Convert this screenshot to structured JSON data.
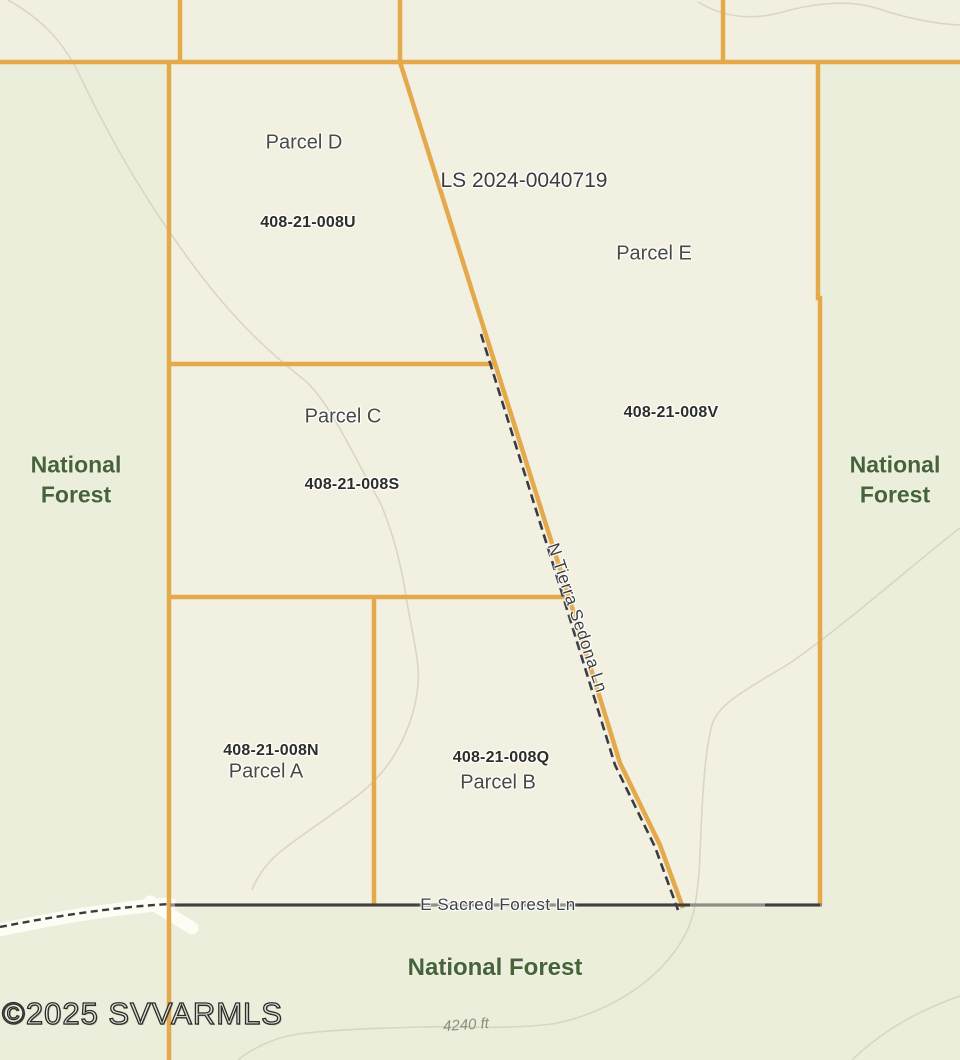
{
  "parcels": [
    {
      "name": "Parcel D",
      "apn": "408-21-008U"
    },
    {
      "name": "Parcel E",
      "apn": "408-21-008V"
    },
    {
      "name": "Parcel C",
      "apn": "408-21-008S"
    },
    {
      "name": "Parcel A",
      "apn": "408-21-008N"
    },
    {
      "name": "Parcel B",
      "apn": "408-21-008Q"
    }
  ],
  "survey_label": "LS 2024-0040719",
  "roads": {
    "tierra": "N Tierra Sedona Ln",
    "sacred": "E Sacred Forest Ln"
  },
  "forest": {
    "left": "National Forest",
    "right": "National Forest",
    "bottom": "National Forest"
  },
  "contour_elevation": "4240 ft",
  "watermark": "©2025 SVVARMLS",
  "colors": {
    "forest-bg": "#ebeeda",
    "parcel-bg": "#f2f0e0",
    "boundary": "#e3a94b",
    "road-dark": "#3a3a42",
    "road-gray": "#8e8e85",
    "contour": "#d9d6c4",
    "forest-text": "#47633a"
  }
}
